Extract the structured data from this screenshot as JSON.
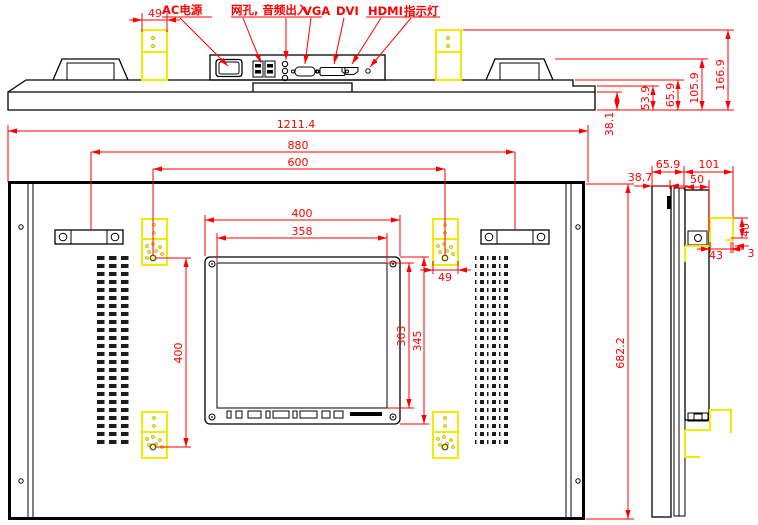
{
  "colors": {
    "dimension_red": "#ff0000",
    "bracket_yellow": "#f2ea00",
    "outline_black": "#000000",
    "background": "#ffffff"
  },
  "port_labels": {
    "ac": "AC电源",
    "net_audio": "网孔, 音频出入",
    "vga": "VGA",
    "dvi": "DVI",
    "hdmi": "HDMI",
    "indicator": "指示灯"
  },
  "dims": {
    "overall_width": "1211.4",
    "handle_spacing": "880",
    "vesa_horizontal": "600",
    "module_width": "400",
    "module_inner_width": "358",
    "module_inner_height": "303",
    "module_height": "345",
    "vesa_vertical": "400",
    "bracket_width": "49",
    "overall_height": "682.2",
    "front_thickness": "38.1",
    "step_thickness": "53.9",
    "body_thickness": "65.9",
    "handle_height": "105.9",
    "bracket_top_height": "166.9",
    "side_total_depth": "101",
    "side_front_thickness": "38.7",
    "side_box_depth": "50",
    "hook_height": "40",
    "hook_depth": "43",
    "hook_gap": "3"
  }
}
